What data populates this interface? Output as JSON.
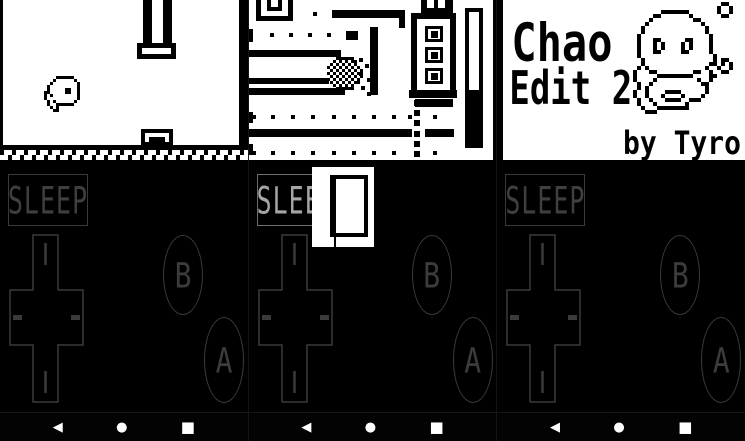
{
  "nav": {
    "back_glyph": "◀",
    "home_glyph": "●",
    "recents_glyph": "■"
  },
  "controls": {
    "sleep_label": "SLEEP",
    "b_label": "B",
    "a_label": "A"
  },
  "colors": {
    "screen_bg": "#ffffff",
    "ink": "#000000",
    "controls_bg": "#000000",
    "skin_stroke": "#3a3a3a",
    "skin_stroke_lit": "#a6a6a6",
    "nav_icon": "#ffffff"
  },
  "screens": {
    "flappy": {
      "rects": [
        {
          "x": 0,
          "y": 0,
          "w": 3,
          "h": 146
        },
        {
          "x": 239,
          "y": 0,
          "w": 9,
          "h": 146
        },
        {
          "x": 143,
          "y": 0,
          "w": 9,
          "h": 44
        },
        {
          "x": 163,
          "y": 0,
          "w": 9,
          "h": 44
        },
        {
          "x": 137,
          "y": 43,
          "w": 39,
          "h": 16,
          "border": 5,
          "fill": "#fff"
        },
        {
          "x": 141,
          "y": 129,
          "w": 32,
          "h": 17,
          "border": 4,
          "fill": "#fff"
        },
        {
          "x": 149,
          "y": 137,
          "w": 16,
          "h": 5
        },
        {
          "x": 0,
          "y": 145,
          "w": 248,
          "h": 5
        }
      ],
      "bird": {
        "x": 44,
        "y": 76,
        "cell": 3,
        "rows": [
          "....######..",
          "...#......#.",
          "..#........#",
          ".#.........#",
          ".#.....##..#",
          "##.....##..#",
          "#.#........#",
          "#..........#",
          ".#.#......#.",
          ".#..######..",
          "..#.#.......",
          "...##......."
        ]
      }
    },
    "maze": {
      "rects": [
        {
          "x": 7,
          "y": 0,
          "w": 5,
          "h": 21
        },
        {
          "x": 39,
          "y": 0,
          "w": 5,
          "h": 21
        },
        {
          "x": 7,
          "y": 16,
          "w": 37,
          "h": 5
        },
        {
          "x": 18,
          "y": 0,
          "w": 4,
          "h": 11
        },
        {
          "x": 29,
          "y": 0,
          "w": 4,
          "h": 11
        },
        {
          "x": 18,
          "y": 7,
          "w": 15,
          "h": 4
        },
        {
          "x": 64,
          "y": 12,
          "w": 4,
          "h": 4
        },
        {
          "x": 83,
          "y": 10,
          "w": 73,
          "h": 8
        },
        {
          "x": 150,
          "y": 18,
          "w": 6,
          "h": 10
        },
        {
          "x": 0,
          "y": 29,
          "w": 4,
          "h": 13
        },
        {
          "x": 97,
          "y": 31,
          "w": 12,
          "h": 9
        },
        {
          "x": 121,
          "y": 27,
          "w": 8,
          "h": 68
        },
        {
          "x": 0,
          "y": 50,
          "w": 92,
          "h": 7
        },
        {
          "x": 0,
          "y": 78,
          "w": 80,
          "h": 6
        },
        {
          "x": 0,
          "y": 88,
          "w": 96,
          "h": 7
        },
        {
          "x": 0,
          "y": 112,
          "w": 4,
          "h": 11
        },
        {
          "x": 0,
          "y": 129,
          "w": 163,
          "h": 8
        },
        {
          "x": 176,
          "y": 129,
          "w": 29,
          "h": 8
        },
        {
          "x": 0,
          "y": 144,
          "w": 4,
          "h": 11
        },
        {
          "x": 165,
          "y": 100,
          "w": 6,
          "h": 6
        },
        {
          "x": 165,
          "y": 110,
          "w": 6,
          "h": 6
        },
        {
          "x": 165,
          "y": 120,
          "w": 6,
          "h": 6
        },
        {
          "x": 165,
          "y": 131,
          "w": 6,
          "h": 6
        },
        {
          "x": 165,
          "y": 141,
          "w": 6,
          "h": 6
        },
        {
          "x": 165,
          "y": 151,
          "w": 6,
          "h": 6
        },
        {
          "x": 172,
          "y": 0,
          "w": 32,
          "h": 14
        },
        {
          "x": 178,
          "y": 0,
          "w": 7,
          "h": 8,
          "fill": "#fff"
        },
        {
          "x": 189,
          "y": 0,
          "w": 7,
          "h": 8,
          "fill": "#fff"
        },
        {
          "x": 162,
          "y": 13,
          "w": 45,
          "h": 85,
          "border": 6,
          "fill": "#fff"
        },
        {
          "x": 176,
          "y": 26,
          "w": 18,
          "h": 16,
          "border": 3,
          "fill": "#fff"
        },
        {
          "x": 182,
          "y": 31,
          "w": 7,
          "h": 7
        },
        {
          "x": 176,
          "y": 47,
          "w": 18,
          "h": 16,
          "border": 3,
          "fill": "#fff"
        },
        {
          "x": 182,
          "y": 52,
          "w": 7,
          "h": 7
        },
        {
          "x": 176,
          "y": 68,
          "w": 18,
          "h": 16,
          "border": 3,
          "fill": "#fff"
        },
        {
          "x": 182,
          "y": 73,
          "w": 7,
          "h": 7
        },
        {
          "x": 160,
          "y": 90,
          "w": 48,
          "h": 8
        },
        {
          "x": 166,
          "y": 99,
          "w": 38,
          "h": 8
        },
        {
          "x": 216,
          "y": 8,
          "w": 18,
          "h": 140,
          "border": 4,
          "fill": "#fff"
        },
        {
          "x": 220,
          "y": 90,
          "w": 10,
          "h": 54
        },
        {
          "x": 244,
          "y": 0,
          "w": 4,
          "h": 160
        },
        {
          "x": 110,
          "y": 58,
          "w": 4,
          "h": 4
        },
        {
          "x": 116,
          "y": 64,
          "w": 4,
          "h": 4
        },
        {
          "x": 110,
          "y": 72,
          "w": 4,
          "h": 4
        },
        {
          "x": 118,
          "y": 78,
          "w": 4,
          "h": 4
        },
        {
          "x": 112,
          "y": 86,
          "w": 4,
          "h": 4
        },
        {
          "x": 118,
          "y": 92,
          "w": 4,
          "h": 4
        }
      ],
      "dots": {
        "size": 4,
        "rows": [
          {
            "y": 33,
            "xs": [
              21,
              40,
              59,
              78
            ]
          },
          {
            "y": 115,
            "xs": [
              3,
              22,
              42,
              62,
              83,
              103,
              123,
              143,
              159,
              184
            ]
          },
          {
            "y": 151,
            "xs": [
              3,
              22,
              42,
              62,
              83,
              103,
              123,
              143,
              184
            ]
          }
        ]
      },
      "player": {
        "x": 78,
        "y": 57,
        "cell": 3,
        "rows": [
          "...######...",
          "..#.#.#.##..",
          ".#.#.#.#.#..",
          "#.#.#.#.#.#.",
          ".#.#.#.#.#.#",
          "#.#.#.#.#.#.",
          ".#.#.#.#.#.#",
          "#.#.#.#.#.#.",
          ".#.#.#.#.##.",
          "..#.#.#.#...",
          "...######..."
        ]
      }
    },
    "title": {
      "line1": "Chao",
      "line2": "Edit 2",
      "credit": "by Tyro",
      "rects": [
        {
          "x": 0,
          "y": 0,
          "w": 6,
          "h": 160
        }
      ],
      "chao": {
        "x": 136,
        "y": 2,
        "cell": 4,
        "rows": [
          "......................##..",
          ".....................#..#.",
          ".......#######.......#..#.",
          ".....##.......#.......##..",
          "....#..........##.........",
          "...#.............#........",
          "..#...............#.......",
          "..#...............#.......",
          ".#.................#......",
          ".#...##......##....#......",
          ".#...#.#....#.#....#......",
          ".#...#.#....#.#....#......",
          ".#...##.....##.....#......",
          ".#..................#.....",
          "..#.................#.##..",
          "..#................##.#.#.",
          ".#.#..............#..#..#.",
          "#...##.........##..#..##..",
          "#.....#########....##.....",
          "#....#..........#..#......",
          ".#..#............##.......",
          ".#.#..............#.......",
          "#..#....####......#.......",
          "#..#...#....#....#........",
          ".#..#...####..###.........",
          ".#...#.......#............",
          "..#...########............",
          "...###...................."
        ]
      }
    }
  },
  "popup": {
    "spade": {
      "x": 4,
      "y": 13,
      "cell": 2,
      "rows": [
        ".....#.....",
        "....###....",
        "...#####...",
        "...#####...",
        "..#######..",
        ".#########.",
        ".#########.",
        ".####.####.",
        "..##...##..",
        ".....#.....",
        "....###....",
        "...#####...",
        "..#######.."
      ]
    }
  }
}
